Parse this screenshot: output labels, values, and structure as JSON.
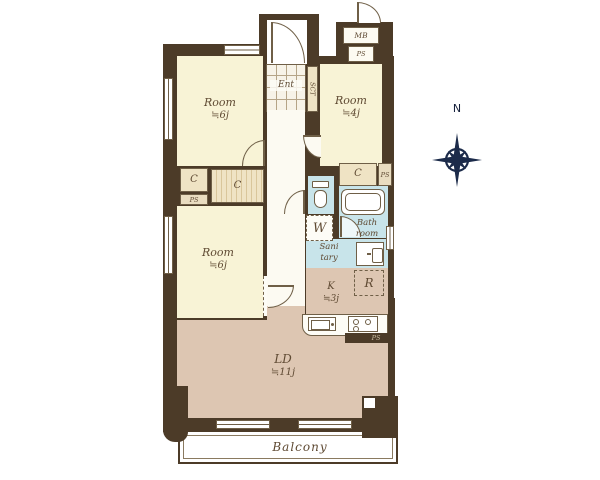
{
  "floor_plan": {
    "rooms": {
      "room_top_left": {
        "name": "Room",
        "size": "≒6j"
      },
      "room_top_right": {
        "name": "Room",
        "size": "≒4j"
      },
      "room_mid_left": {
        "name": "Room",
        "size": "≒6j"
      },
      "living_dining": {
        "name": "LD",
        "size": "≒11j"
      },
      "kitchen": {
        "name": "K",
        "size": "≒3j"
      },
      "bathroom": {
        "line1": "Bath",
        "line2": "room"
      },
      "sanitary": {
        "line1": "Sani",
        "line2": "tary"
      },
      "entrance": {
        "label": "Ent"
      },
      "balcony": {
        "label": "Balcony"
      }
    },
    "labels": {
      "meter_box": "MB",
      "pipe_space": "PS",
      "closet": "C",
      "shoe_cabinet": "SCT",
      "washing_machine": "W",
      "refrigerator": "R"
    },
    "compass": {
      "north": "N"
    },
    "colors": {
      "wall": "#4c3b28",
      "room_floor": "#f8f3d6",
      "wood_floor": "#ddc6b2",
      "wet_area": "#c8e4ea",
      "closet_fill": "#efe3c4",
      "label_text": "#5f4a33",
      "compass": "#1c2b4a"
    }
  }
}
